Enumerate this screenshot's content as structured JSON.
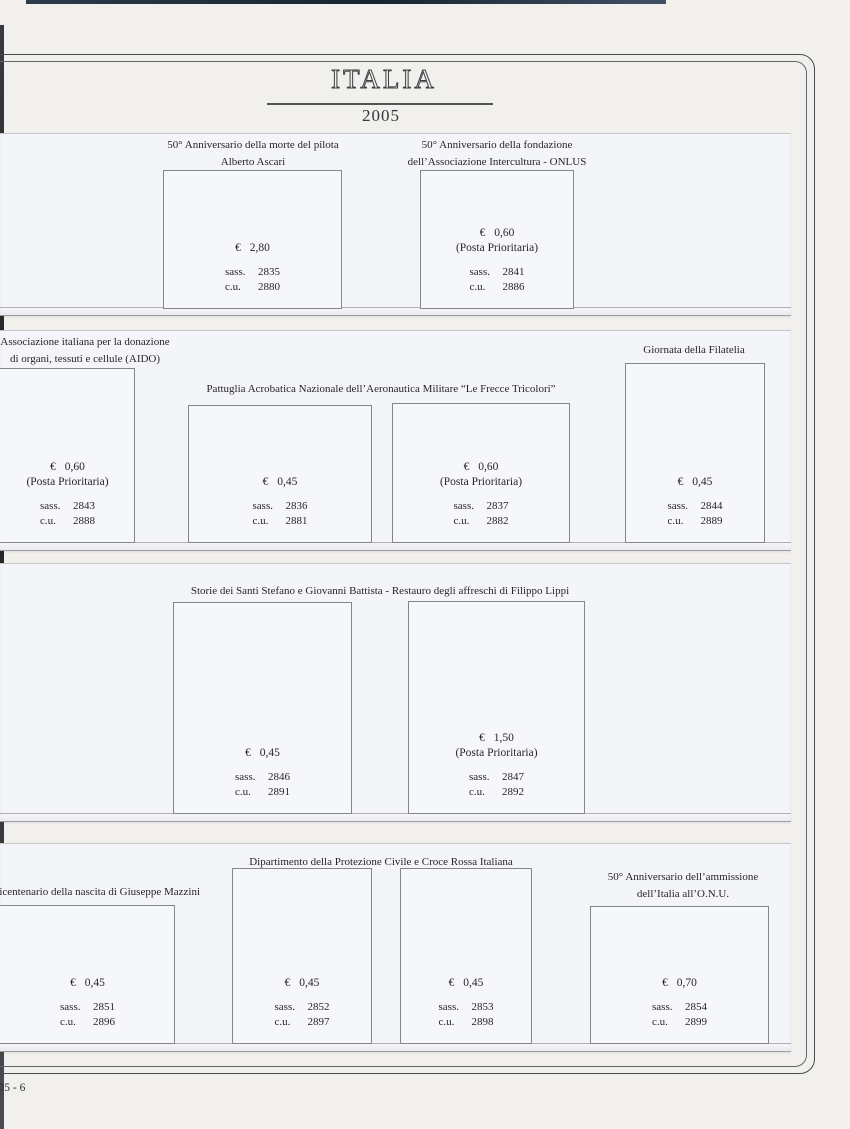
{
  "page": {
    "title": "ITALIA",
    "year": "2005",
    "page_number": "2005 - 6"
  },
  "labels": {
    "sass": "sass.",
    "cu": "c.u."
  },
  "colors": {
    "page_bg": "#f2f0ec",
    "strip_bg": "#f4f5f8",
    "frame": "#4a4a52",
    "text": "#26262a"
  },
  "sections": [
    {
      "captions": [
        {
          "text": "50° Anniversario della morte del pilota\nAlberto Ascari"
        },
        {
          "text": "50° Anniversario della fondazione\ndell’Associazione Intercultura - ONLUS"
        }
      ],
      "stamps": [
        {
          "value": "€ 2,80",
          "sass": "2835",
          "cu": "2880"
        },
        {
          "value": "€ 0,60",
          "priority": "(Posta Prioritaria)",
          "sass": "2841",
          "cu": "2886"
        }
      ]
    },
    {
      "captions": [
        {
          "text": "Associazione italiana per la donazione\ndi organi, tessuti e cellule (AIDO)"
        },
        {
          "text": "Pattuglia Acrobatica Nazionale dell’Aeronautica Militare “Le Frecce Tricolori”"
        },
        {
          "text": "Giornata della Filatelia"
        }
      ],
      "stamps": [
        {
          "value": "€ 0,60",
          "priority": "(Posta Prioritaria)",
          "sass": "2843",
          "cu": "2888"
        },
        {
          "value": "€ 0,45",
          "sass": "2836",
          "cu": "2881"
        },
        {
          "value": "€ 0,60",
          "priority": "(Posta Prioritaria)",
          "sass": "2837",
          "cu": "2882"
        },
        {
          "value": "€ 0,45",
          "sass": "2844",
          "cu": "2889"
        }
      ]
    },
    {
      "captions": [
        {
          "text": "Storie dei Santi Stefano e Giovanni Battista - Restauro degli affreschi di Filippo Lippi"
        }
      ],
      "stamps": [
        {
          "value": "€ 0,45",
          "sass": "2846",
          "cu": "2891"
        },
        {
          "value": "€ 1,50",
          "priority": "(Posta Prioritaria)",
          "sass": "2847",
          "cu": "2892"
        }
      ]
    },
    {
      "captions": [
        {
          "text": "Dipartimento della Protezione Civile e Croce Rossa Italiana"
        },
        {
          "text": "Bicentenario della nascita di Giuseppe Mazzini"
        },
        {
          "text": "50° Anniversario dell’ammissione\ndell’Italia all’O.N.U."
        }
      ],
      "stamps": [
        {
          "value": "€ 0,45",
          "sass": "2851",
          "cu": "2896"
        },
        {
          "value": "€ 0,45",
          "sass": "2852",
          "cu": "2897"
        },
        {
          "value": "€ 0,45",
          "sass": "2853",
          "cu": "2898"
        },
        {
          "value": "€ 0,70",
          "sass": "2854",
          "cu": "2899"
        }
      ]
    }
  ]
}
